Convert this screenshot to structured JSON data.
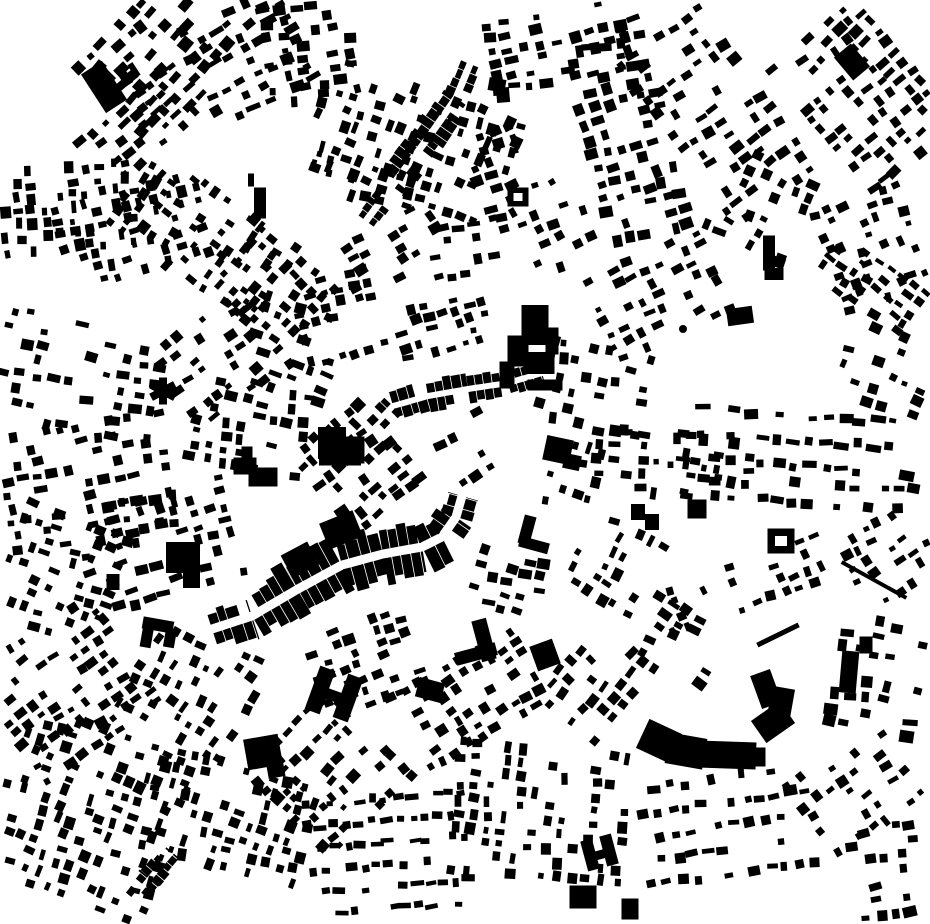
{
  "map": {
    "type": "figure-ground",
    "width": 930,
    "height": 924,
    "seed": 11,
    "colors": {
      "building": "#000000",
      "background": "#ffffff",
      "street": "#ffffff"
    },
    "district_fields": [
      "cx",
      "cy",
      "w",
      "h",
      "angle",
      "sx",
      "sy",
      "bw",
      "bh",
      "skip"
    ],
    "districts": [
      [
        165,
        48,
        150,
        95,
        -45,
        15,
        15,
        9,
        8,
        0.3
      ],
      [
        252,
        55,
        110,
        100,
        -25,
        17,
        14,
        10,
        7,
        0.35
      ],
      [
        318,
        55,
        95,
        100,
        -8,
        16,
        13,
        9,
        7,
        0.38
      ],
      [
        150,
        122,
        130,
        58,
        -40,
        15,
        13,
        9,
        6,
        0.35
      ],
      [
        55,
        215,
        90,
        150,
        85,
        13,
        14,
        8,
        7,
        0.35
      ],
      [
        128,
        232,
        78,
        150,
        75,
        13,
        14,
        8,
        7,
        0.4
      ],
      [
        205,
        235,
        88,
        170,
        -55,
        14,
        14,
        8,
        7,
        0.4
      ],
      [
        272,
        282,
        80,
        108,
        -50,
        15,
        13,
        8,
        7,
        0.45
      ],
      [
        415,
        140,
        110,
        200,
        -70,
        15,
        14,
        8,
        7,
        0.42
      ],
      [
        558,
        52,
        130,
        75,
        -10,
        16,
        13,
        9,
        7,
        0.4
      ],
      [
        505,
        172,
        55,
        85,
        -20,
        15,
        14,
        9,
        7,
        0.45
      ],
      [
        630,
        130,
        85,
        210,
        -15,
        15,
        15,
        9,
        8,
        0.4
      ],
      [
        722,
        112,
        110,
        195,
        -35,
        16,
        15,
        9,
        7,
        0.45
      ],
      [
        868,
        92,
        118,
        158,
        -40,
        15,
        13,
        9,
        7,
        0.35
      ],
      [
        880,
        252,
        95,
        115,
        -20,
        14,
        13,
        8,
        7,
        0.4
      ],
      [
        762,
        212,
        88,
        95,
        25,
        16,
        14,
        9,
        7,
        0.5
      ],
      [
        660,
        300,
        120,
        95,
        -25,
        15,
        14,
        8,
        7,
        0.45
      ],
      [
        872,
        292,
        108,
        58,
        35,
        14,
        12,
        8,
        6,
        0.35
      ],
      [
        85,
        382,
        165,
        115,
        10,
        17,
        15,
        9,
        7,
        0.5
      ],
      [
        95,
        482,
        175,
        115,
        -10,
        16,
        14,
        9,
        7,
        0.48
      ],
      [
        225,
        362,
        108,
        95,
        -35,
        15,
        14,
        8,
        7,
        0.45
      ],
      [
        300,
        352,
        95,
        85,
        20,
        16,
        14,
        9,
        7,
        0.45
      ],
      [
        255,
        432,
        118,
        85,
        10,
        15,
        13,
        9,
        7,
        0.45
      ],
      [
        162,
        548,
        148,
        105,
        -15,
        16,
        14,
        9,
        7,
        0.45
      ],
      [
        60,
        582,
        108,
        125,
        20,
        15,
        14,
        8,
        7,
        0.45
      ],
      [
        345,
        315,
        88,
        78,
        -15,
        15,
        13,
        8,
        7,
        0.4
      ],
      [
        362,
        470,
        88,
        105,
        -40,
        14,
        12,
        9,
        8,
        0.3
      ],
      [
        447,
        330,
        88,
        58,
        -15,
        14,
        12,
        8,
        7,
        0.35
      ],
      [
        470,
        452,
        78,
        68,
        -30,
        16,
        14,
        9,
        7,
        0.65
      ],
      [
        600,
        382,
        88,
        108,
        -80,
        15,
        14,
        8,
        7,
        0.45
      ],
      [
        668,
        470,
        68,
        158,
        95,
        14,
        15,
        8,
        8,
        0.4
      ],
      [
        800,
        450,
        235,
        68,
        4,
        16,
        25,
        10,
        7,
        0.35
      ],
      [
        802,
        502,
        230,
        38,
        4,
        15,
        20,
        9,
        7,
        0.4
      ],
      [
        890,
        560,
        75,
        78,
        -30,
        15,
        14,
        8,
        7,
        0.45
      ],
      [
        75,
        690,
        148,
        138,
        -35,
        15,
        14,
        8,
        7,
        0.4
      ],
      [
        200,
        682,
        118,
        118,
        -60,
        15,
        14,
        8,
        7,
        0.45
      ],
      [
        92,
        812,
        175,
        175,
        -70,
        14,
        14,
        8,
        7,
        0.4
      ],
      [
        232,
        812,
        108,
        158,
        -75,
        14,
        14,
        8,
        7,
        0.45
      ],
      [
        332,
        772,
        118,
        118,
        -45,
        14,
        13,
        8,
        7,
        0.4
      ],
      [
        395,
        855,
        168,
        115,
        -5,
        13,
        22,
        9,
        6,
        0.35
      ],
      [
        545,
        812,
        128,
        175,
        -85,
        14,
        15,
        8,
        7,
        0.4
      ],
      [
        478,
        700,
        148,
        88,
        -30,
        15,
        13,
        8,
        7,
        0.45
      ],
      [
        602,
        682,
        98,
        78,
        -50,
        15,
        14,
        9,
        7,
        0.45
      ],
      [
        730,
        835,
        168,
        115,
        -8,
        15,
        24,
        9,
        7,
        0.35
      ],
      [
        862,
        790,
        115,
        95,
        -35,
        15,
        14,
        8,
        7,
        0.55
      ],
      [
        745,
        592,
        165,
        55,
        -20,
        15,
        14,
        8,
        7,
        0.45
      ],
      [
        682,
        642,
        88,
        58,
        30,
        16,
        14,
        9,
        7,
        0.5
      ],
      [
        880,
        682,
        85,
        115,
        10,
        16,
        15,
        10,
        8,
        0.45
      ],
      [
        892,
        872,
        68,
        88,
        -10,
        15,
        14,
        9,
        7,
        0.5
      ],
      [
        398,
        252,
        115,
        58,
        -30,
        15,
        13,
        8,
        7,
        0.45
      ],
      [
        378,
        180,
        40,
        130,
        -75,
        14,
        14,
        8,
        7,
        0.4
      ],
      [
        472,
        252,
        78,
        55,
        -10,
        15,
        12,
        9,
        7,
        0.5
      ],
      [
        560,
        225,
        70,
        90,
        -25,
        15,
        14,
        8,
        7,
        0.5
      ],
      [
        615,
        560,
        80,
        70,
        -60,
        15,
        14,
        8,
        7,
        0.5
      ],
      [
        512,
        588,
        70,
        60,
        15,
        15,
        13,
        9,
        7,
        0.45
      ],
      [
        595,
        478,
        70,
        85,
        -75,
        15,
        14,
        8,
        7,
        0.55
      ],
      [
        370,
        668,
        105,
        90,
        -20,
        14,
        13,
        8,
        7,
        0.4
      ],
      [
        885,
        372,
        80,
        75,
        20,
        16,
        14,
        8,
        7,
        0.55
      ]
    ],
    "strips": [
      {
        "path": [
          [
            212,
            629
          ],
          [
            252,
            616
          ],
          [
            298,
            589
          ],
          [
            342,
            565
          ],
          [
            383,
            554
          ],
          [
            422,
            547
          ],
          [
            442,
            537
          ],
          [
            456,
            517
          ],
          [
            462,
            496
          ]
        ],
        "half": 4.5,
        "dmin": 12,
        "dmax": 22,
        "wmin": 7,
        "wmax": 13,
        "skip": 0.06
      },
      {
        "path": [
          [
            366,
            221
          ],
          [
            398,
            178
          ],
          [
            428,
            138
          ],
          [
            456,
            98
          ],
          [
            470,
            64
          ]
        ],
        "half": 3.5,
        "dmin": 7,
        "dmax": 12,
        "wmin": 6,
        "wmax": 10,
        "skip": 0.2
      },
      {
        "path": [
          [
            370,
            430
          ],
          [
            393,
            406
          ],
          [
            428,
            396
          ],
          [
            468,
            389
          ],
          [
            508,
            383
          ],
          [
            542,
            373
          ]
        ],
        "half": 3.0,
        "dmin": 7,
        "dmax": 11,
        "wmin": 6,
        "wmax": 10,
        "skip": 0.25
      },
      {
        "path": [
          [
            128,
            905
          ],
          [
            150,
            878
          ],
          [
            172,
            852
          ]
        ],
        "half": 2.5,
        "dmin": 6,
        "dmax": 9,
        "wmin": 6,
        "wmax": 9,
        "skip": 0.3
      }
    ],
    "landmarks": [
      {
        "t": "r",
        "x": 104,
        "y": 87,
        "w": 25,
        "h": 46,
        "a": -33
      },
      {
        "t": "r",
        "x": 124,
        "y": 76,
        "w": 9,
        "h": 20,
        "a": -33
      },
      {
        "t": "r",
        "x": 134,
        "y": 70,
        "w": 6,
        "h": 15,
        "a": -33
      },
      {
        "t": "r",
        "x": 260,
        "y": 203,
        "w": 12,
        "h": 31,
        "a": 0
      },
      {
        "t": "r",
        "x": 251,
        "y": 180,
        "w": 6,
        "h": 13,
        "a": 0
      },
      {
        "t": "r",
        "x": 518,
        "y": 197,
        "w": 21,
        "h": 19,
        "a": 0
      },
      {
        "t": "h",
        "x": 518,
        "y": 197,
        "w": 9,
        "h": 8,
        "a": 0
      },
      {
        "t": "r",
        "x": 497,
        "y": 85,
        "w": 17,
        "h": 13,
        "a": 10
      },
      {
        "t": "r",
        "x": 503,
        "y": 95,
        "w": 13,
        "h": 15,
        "a": -5
      },
      {
        "t": "r",
        "x": 535,
        "y": 325,
        "w": 27,
        "h": 40,
        "a": 0
      },
      {
        "t": "r",
        "x": 518,
        "y": 351,
        "w": 21,
        "h": 31,
        "a": 0
      },
      {
        "t": "r",
        "x": 539,
        "y": 363,
        "w": 31,
        "h": 22,
        "a": 0
      },
      {
        "t": "r",
        "x": 507,
        "y": 375,
        "w": 15,
        "h": 27,
        "a": 0
      },
      {
        "t": "r",
        "x": 545,
        "y": 385,
        "w": 35,
        "h": 11,
        "a": 0
      },
      {
        "t": "r",
        "x": 552,
        "y": 341,
        "w": 13,
        "h": 27,
        "a": 0
      },
      {
        "t": "r",
        "x": 558,
        "y": 450,
        "w": 27,
        "h": 25,
        "a": 12
      },
      {
        "t": "r",
        "x": 572,
        "y": 462,
        "w": 17,
        "h": 15,
        "a": 12
      },
      {
        "t": "r",
        "x": 527,
        "y": 530,
        "w": 12,
        "h": 29,
        "a": 15
      },
      {
        "t": "r",
        "x": 534,
        "y": 545,
        "w": 30,
        "h": 11,
        "a": 15
      },
      {
        "t": "r",
        "x": 163,
        "y": 391,
        "w": 8,
        "h": 27,
        "a": 0
      },
      {
        "t": "r",
        "x": 163,
        "y": 391,
        "w": 8,
        "h": 27,
        "a": 62
      },
      {
        "t": "r",
        "x": 163,
        "y": 391,
        "w": 8,
        "h": 27,
        "a": -62
      },
      {
        "t": "r",
        "x": 245,
        "y": 466,
        "w": 23,
        "h": 17,
        "a": 0
      },
      {
        "t": "r",
        "x": 263,
        "y": 477,
        "w": 29,
        "h": 19,
        "a": 0
      },
      {
        "t": "r",
        "x": 247,
        "y": 453,
        "w": 11,
        "h": 13,
        "a": 0
      },
      {
        "t": "p",
        "pts": [
          [
            166,
            542
          ],
          [
            200,
            542
          ],
          [
            200,
            588
          ],
          [
            183,
            588
          ],
          [
            183,
            573
          ],
          [
            166,
            573
          ]
        ]
      },
      {
        "t": "r",
        "x": 113,
        "y": 582,
        "w": 13,
        "h": 16,
        "a": 0
      },
      {
        "t": "r",
        "x": 263,
        "y": 752,
        "w": 35,
        "h": 31,
        "a": -10
      },
      {
        "t": "r",
        "x": 276,
        "y": 771,
        "w": 17,
        "h": 13,
        "a": -10
      },
      {
        "t": "r",
        "x": 320,
        "y": 690,
        "w": 16,
        "h": 46,
        "a": 20
      },
      {
        "t": "r",
        "x": 348,
        "y": 698,
        "w": 16,
        "h": 46,
        "a": 20
      },
      {
        "t": "r",
        "x": 334,
        "y": 696,
        "w": 19,
        "h": 11,
        "a": 20
      },
      {
        "t": "r",
        "x": 484,
        "y": 640,
        "w": 15,
        "h": 42,
        "a": -15
      },
      {
        "t": "r",
        "x": 476,
        "y": 654,
        "w": 42,
        "h": 13,
        "a": -15
      },
      {
        "t": "r",
        "x": 659,
        "y": 741,
        "w": 36,
        "h": 32,
        "a": 25
      },
      {
        "t": "r",
        "x": 686,
        "y": 751,
        "w": 38,
        "h": 31,
        "a": 10
      },
      {
        "t": "r",
        "x": 727,
        "y": 755,
        "w": 58,
        "h": 27,
        "a": 2
      },
      {
        "t": "r",
        "x": 757,
        "y": 757,
        "w": 17,
        "h": 19,
        "a": 0
      },
      {
        "t": "r",
        "x": 773,
        "y": 722,
        "w": 35,
        "h": 27,
        "a": -35
      },
      {
        "t": "r",
        "x": 766,
        "y": 689,
        "w": 21,
        "h": 35,
        "a": -20
      },
      {
        "t": "r",
        "x": 781,
        "y": 703,
        "w": 23,
        "h": 31,
        "a": 10
      },
      {
        "t": "r",
        "x": 849,
        "y": 672,
        "w": 17,
        "h": 42,
        "a": 5
      },
      {
        "t": "r",
        "x": 866,
        "y": 645,
        "w": 13,
        "h": 17,
        "a": 0
      },
      {
        "t": "r",
        "x": 781,
        "y": 541,
        "w": 27,
        "h": 25,
        "a": 0
      },
      {
        "t": "h",
        "x": 781,
        "y": 541,
        "w": 12,
        "h": 10,
        "a": 0
      },
      {
        "t": "r",
        "x": 769,
        "y": 253,
        "w": 12,
        "h": 35,
        "a": 0
      },
      {
        "t": "r",
        "x": 774,
        "y": 274,
        "w": 19,
        "h": 12,
        "a": 0
      },
      {
        "t": "r",
        "x": 874,
        "y": 580,
        "w": 74,
        "h": 4,
        "a": 29
      },
      {
        "t": "r",
        "x": 778,
        "y": 635,
        "w": 46,
        "h": 5,
        "a": -26
      },
      {
        "t": "r",
        "x": 583,
        "y": 897,
        "w": 27,
        "h": 23,
        "a": 0
      },
      {
        "t": "r",
        "x": 590,
        "y": 855,
        "w": 12,
        "h": 31,
        "a": -15
      },
      {
        "t": "r",
        "x": 609,
        "y": 850,
        "w": 12,
        "h": 31,
        "a": -15
      },
      {
        "t": "r",
        "x": 599,
        "y": 855,
        "w": 15,
        "h": 9,
        "a": -15
      },
      {
        "t": "r",
        "x": 158,
        "y": 625,
        "w": 31,
        "h": 12,
        "a": 10
      },
      {
        "t": "r",
        "x": 147,
        "y": 636,
        "w": 11,
        "h": 23,
        "a": 10
      },
      {
        "t": "r",
        "x": 170,
        "y": 638,
        "w": 11,
        "h": 19,
        "a": 10
      },
      {
        "t": "r",
        "x": 630,
        "y": 909,
        "w": 17,
        "h": 21,
        "a": 0
      },
      {
        "t": "c",
        "x": 683,
        "y": 329,
        "r": 4
      },
      {
        "t": "r",
        "x": 332,
        "y": 443,
        "w": 28,
        "h": 32,
        "a": 0
      },
      {
        "t": "r",
        "x": 355,
        "y": 450,
        "w": 19,
        "h": 27,
        "a": 0
      },
      {
        "t": "r",
        "x": 340,
        "y": 459,
        "w": 42,
        "h": 13,
        "a": 0
      },
      {
        "t": "r",
        "x": 341,
        "y": 530,
        "w": 36,
        "h": 28,
        "a": -22
      },
      {
        "t": "r",
        "x": 300,
        "y": 560,
        "w": 30,
        "h": 26,
        "a": -28
      },
      {
        "t": "r",
        "x": 430,
        "y": 690,
        "w": 26,
        "h": 20,
        "a": 15
      },
      {
        "t": "r",
        "x": 545,
        "y": 655,
        "w": 24,
        "h": 26,
        "a": -20
      },
      {
        "t": "r",
        "x": 852,
        "y": 62,
        "w": 22,
        "h": 30,
        "a": -40
      },
      {
        "t": "r",
        "x": 740,
        "y": 316,
        "w": 26,
        "h": 17,
        "a": -8
      },
      {
        "t": "r",
        "x": 697,
        "y": 509,
        "w": 19,
        "h": 19,
        "a": 0
      },
      {
        "t": "r",
        "x": 638,
        "y": 512,
        "w": 14,
        "h": 16,
        "a": 0
      },
      {
        "t": "r",
        "x": 652,
        "y": 522,
        "w": 14,
        "h": 16,
        "a": 0
      },
      {
        "t": "r",
        "x": 781,
        "y": 258,
        "w": 10,
        "h": 8,
        "a": 20
      }
    ]
  }
}
